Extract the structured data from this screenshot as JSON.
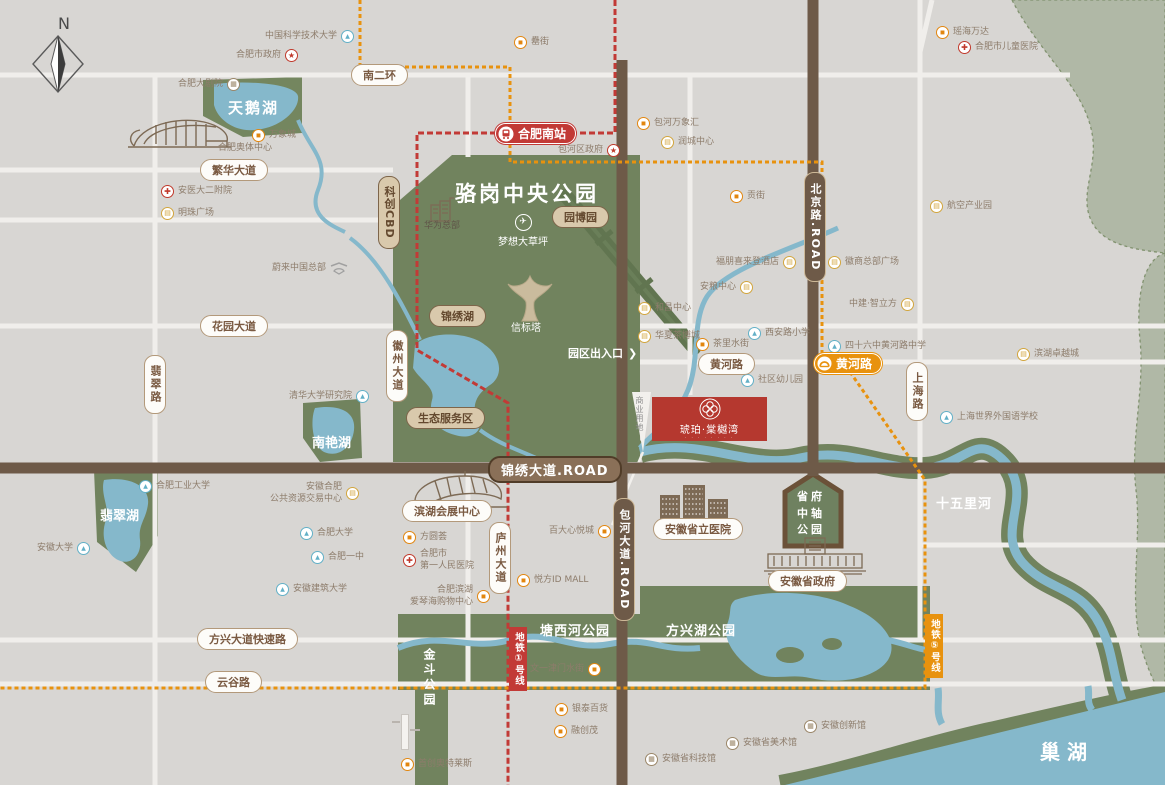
{
  "colors": {
    "background": "#d8d6d3",
    "park_green": "#71835e",
    "pale_green": "#b0b8a6",
    "water": "#85b8cb",
    "road_brown": "#6e5a48",
    "white_road": "#f0eeeb",
    "metro_line1_red": "#c23a36",
    "metro_line5_orange": "#e8920e",
    "poi_text": "#8d7c6b",
    "pill_text": "#7a5a42",
    "project_red": "#b5382f",
    "icon_mall": "#e2860f",
    "icon_business": "#d2a53d",
    "icon_school": "#62b0c7",
    "icon_hospital": "#c0392b",
    "icon_museum": "#9a8668"
  },
  "compass": {
    "label": "N"
  },
  "park": {
    "title": "骆岗中央公园"
  },
  "areas": {
    "tianehu": "天鹅湖",
    "nanyanhu": "南艳湖",
    "feicuihu": "翡翠湖",
    "tangxihe": "塘西河公园",
    "fangxinghu": "方兴湖公园",
    "jindou": "金斗公园",
    "shiwulihe": "十五里河",
    "chaohu": "巢湖",
    "shengfu": "省府\n中轴\n公园",
    "mengxiang": "梦想大草坪",
    "xinbiaota": "信标塔",
    "chukou": "园区出入口",
    "chukou_arrow": "❯",
    "shangye": "商业用地"
  },
  "roads": {
    "nanerhuan": "南二环",
    "fanhua": "繁华大道",
    "huayuan": "花园大道",
    "feicui": "翡翠路",
    "huizhou": "徽州大道",
    "huanghe": "黄河路",
    "shanghai": "上海路",
    "luzhou": "庐州大道",
    "jinxiu": "锦绣大道.ROAD",
    "beijing": "北京路.ROAD",
    "baohe": "包河大道.ROAD",
    "fangxing": "方兴大道快速路",
    "yungu": "云谷路"
  },
  "pills": {
    "yuanbo": "园博园",
    "jinxiuhu": "锦绣湖",
    "shengtai": "生态服务区",
    "kechuang": "科创CBD",
    "convention": "滨湖会展中心",
    "hospital": "安徽省立医院",
    "gov": "安徽省政府"
  },
  "metro": {
    "south_station": "合肥南站",
    "huanghe_station": "黄河路",
    "line1": "地铁①号线",
    "line5": "地铁⑤号线"
  },
  "project": {
    "name": "琥珀·棠樾湾",
    "subtext": "· · · · · · · ·"
  },
  "pois": [
    {
      "label": "中国科学技术大学",
      "icon": "school"
    },
    {
      "label": "合肥市政府",
      "icon": "gov"
    },
    {
      "label": "合肥大剧院",
      "icon": "museum"
    },
    {
      "label": "万象城",
      "icon": "mall"
    },
    {
      "label": "合肥奥体中心",
      "icon": "none"
    },
    {
      "label": "安医大二附院",
      "icon": "hospital"
    },
    {
      "label": "明珠广场",
      "icon": "biz"
    },
    {
      "label": "罍街",
      "icon": "mall"
    },
    {
      "label": "包河万象汇",
      "icon": "mall"
    },
    {
      "label": "润城中心",
      "icon": "biz"
    },
    {
      "label": "包河区政府",
      "icon": "gov"
    },
    {
      "label": "瑶海万达",
      "icon": "mall"
    },
    {
      "label": "合肥市儿童医院",
      "icon": "hospital"
    },
    {
      "label": "航空产业园",
      "icon": "biz"
    },
    {
      "label": "贡街",
      "icon": "mall"
    },
    {
      "label": "徽商总部广场",
      "icon": "biz"
    },
    {
      "label": "福朋喜来登酒店",
      "icon": "biz"
    },
    {
      "label": "安粮中心",
      "icon": "biz"
    },
    {
      "label": "中建·智立方",
      "icon": "biz"
    },
    {
      "label": "西安路小学",
      "icon": "school"
    },
    {
      "label": "四十六中黄河路中学",
      "icon": "school"
    },
    {
      "label": "茶里水街",
      "icon": "mall"
    },
    {
      "label": "滨湖卓越城",
      "icon": "biz"
    },
    {
      "label": "社区幼儿园",
      "icon": "school"
    },
    {
      "label": "上海世界外国语学校",
      "icon": "school"
    },
    {
      "label": "和昌中心",
      "icon": "biz"
    },
    {
      "label": "华夏茶博城",
      "icon": "biz"
    },
    {
      "label": "蔚来中国总部",
      "icon": "nio"
    },
    {
      "label": "清华大学研究院",
      "icon": "school"
    },
    {
      "label": "合肥工业大学",
      "icon": "school"
    },
    {
      "label": "安徽合肥\n公共资源交易中心",
      "icon": "biz"
    },
    {
      "label": "安徽大学",
      "icon": "school"
    },
    {
      "label": "合肥大学",
      "icon": "school"
    },
    {
      "label": "合肥一中",
      "icon": "school"
    },
    {
      "label": "安徽建筑大学",
      "icon": "school"
    },
    {
      "label": "方圆荟",
      "icon": "mall"
    },
    {
      "label": "合肥市\n第一人民医院",
      "icon": "hospital"
    },
    {
      "label": "合肥滨湖\n爱琴海购物中心",
      "icon": "mall"
    },
    {
      "label": "百大心悦城",
      "icon": "mall"
    },
    {
      "label": "悦方ID MALL",
      "icon": "mall"
    },
    {
      "label": "文一津门水街",
      "icon": "mall"
    },
    {
      "label": "银泰百货",
      "icon": "mall"
    },
    {
      "label": "融创茂",
      "icon": "mall"
    },
    {
      "label": "首创奥特莱斯",
      "icon": "mall"
    },
    {
      "label": "安徽省科技馆",
      "icon": "museum"
    },
    {
      "label": "安徽省美术馆",
      "icon": "museum"
    },
    {
      "label": "安徽创新馆",
      "icon": "museum"
    },
    {
      "label": "华为总部",
      "icon": "none"
    }
  ]
}
